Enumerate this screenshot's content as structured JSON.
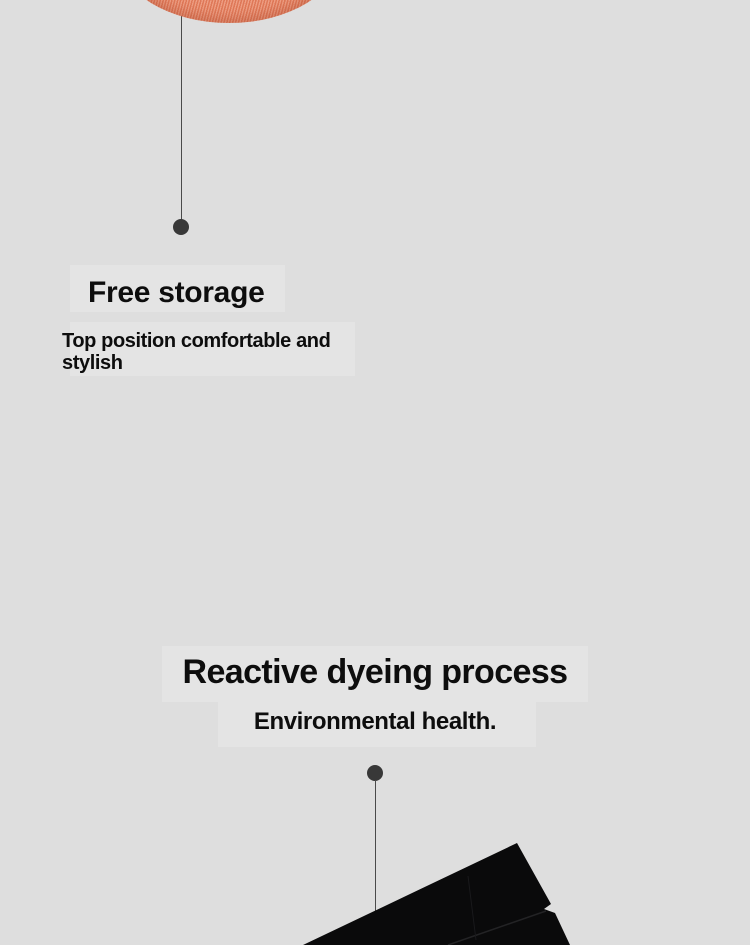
{
  "page": {
    "kind": "product-description-section",
    "background_color": "#dedede"
  },
  "colors": {
    "background": "#dedede",
    "text_ink": "#0d0d0d",
    "accent_orange_fabric": "#e8805f",
    "callout_line": "#4a4a4a",
    "callout_dot": "#383838",
    "garment_black": "#0a0a0b",
    "highlight_box": "#e4e4e4"
  },
  "sections": [
    {
      "id": "free-storage",
      "title": "Free storage",
      "subtitle": "Top position comfortable and stylish"
    },
    {
      "id": "reactive-dyeing",
      "title": "Reactive dyeing process",
      "subtitle": "Environmental health."
    }
  ],
  "figures": [
    {
      "name": "orange-knit-fabric-swatch",
      "description_color": "#e8805f"
    },
    {
      "name": "black-garment-photo",
      "description_color": "#0a0a0b"
    }
  ]
}
